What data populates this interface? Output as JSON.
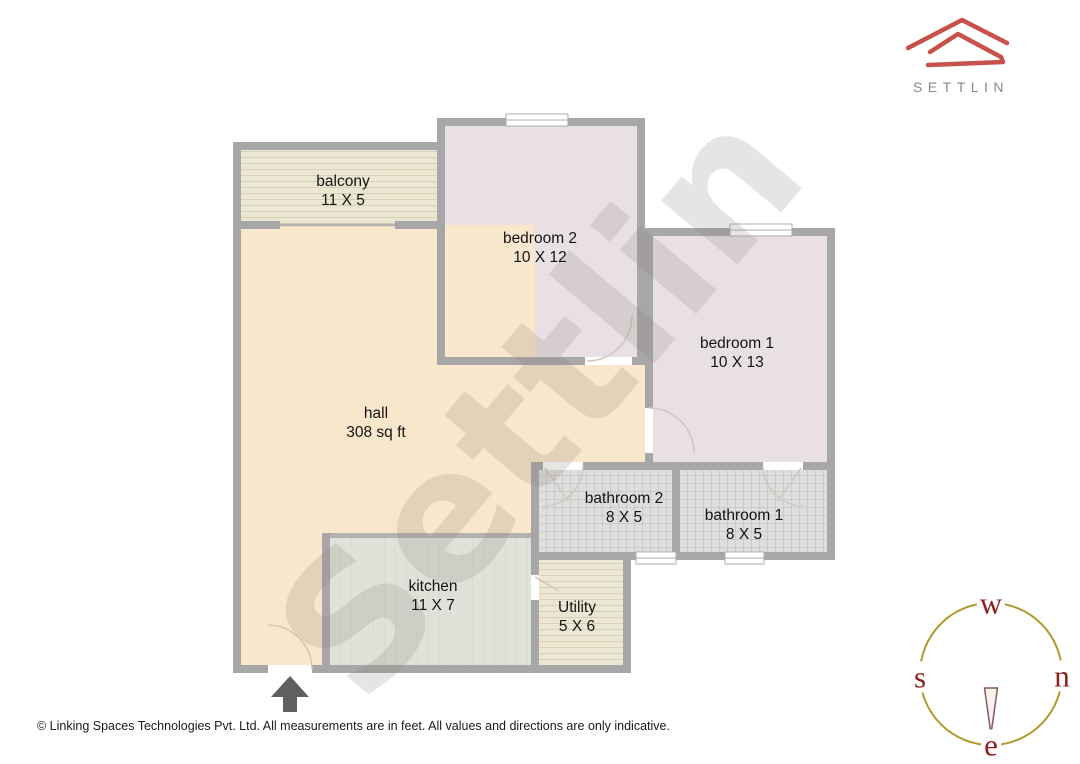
{
  "logo": {
    "brand": "SETTLIN",
    "mark": "roof-outline-icon",
    "mark_color": "#c9514b",
    "text_color": "#8a8a8a"
  },
  "watermark": {
    "text": "Settlin"
  },
  "floorplan": {
    "rooms": [
      {
        "name": "balcony",
        "dims": "11 X 5"
      },
      {
        "name": "bedroom 2",
        "dims": "10 X 12"
      },
      {
        "name": "bedroom 1",
        "dims": "10 X 13"
      },
      {
        "name": "hall",
        "dims": "308 sq ft"
      },
      {
        "name": "bathroom 2",
        "dims": "8 X 5"
      },
      {
        "name": "bathroom 1",
        "dims": "8 X 5"
      },
      {
        "name": "kitchen",
        "dims": "11 X 7"
      },
      {
        "name": "Utility",
        "dims": "5 X 6"
      }
    ],
    "entrance_marker": "up-arrow",
    "colors": {
      "wall": "#a7a7a7",
      "hall": "#f8e7ca",
      "bedroom": "#e8e0e4",
      "balcony": "#ebe7d3",
      "kitchen": "#e0e2da",
      "bathroom": "#dedede",
      "utility": "#ebe7d3",
      "door_arc": "#d2c9bd"
    }
  },
  "compass": {
    "top": "w",
    "left": "s",
    "right": "n",
    "bottom": "e",
    "ring_color": "#b1992f",
    "letter_color": "#8e1f1f"
  },
  "footer": {
    "text": "© Linking Spaces Technologies Pvt. Ltd. All measurements are in feet. All values and directions are only indicative."
  }
}
